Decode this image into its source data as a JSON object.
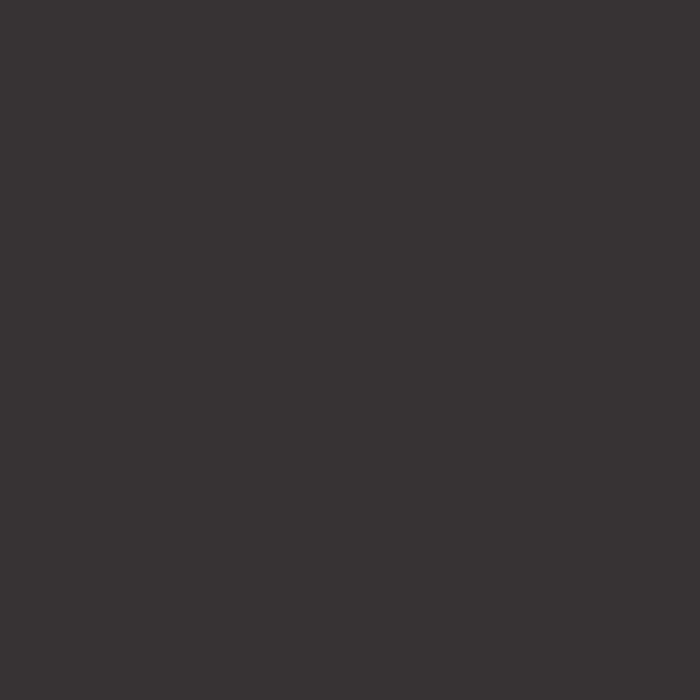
{
  "screen": {
    "state": "blank",
    "content_text": ""
  },
  "colors": {
    "background": "#373334"
  }
}
